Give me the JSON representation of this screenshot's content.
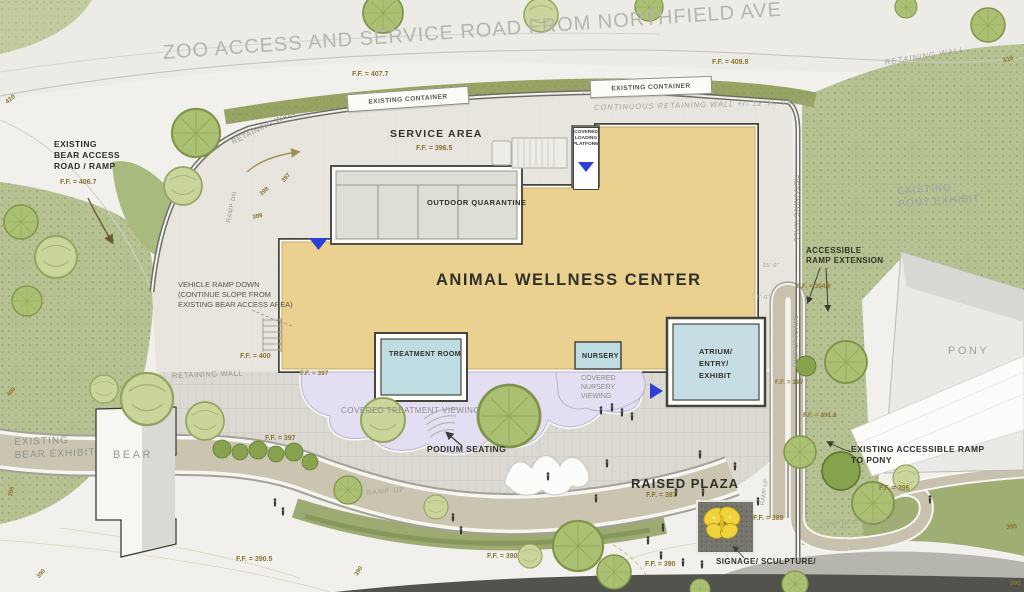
{
  "colors": {
    "building_fill": "#ebd190",
    "room_fill": "#bedce2",
    "viewing_canopy_fill": "#e4def2",
    "entry_arrow_blue": "#2d3fd6",
    "elevation_text_gold": "#8a7331",
    "landscape_green": "#b7c292",
    "sculpture_yellow": "#f0d33c"
  },
  "header": {
    "road_title": "ZOO ACCESS AND SERVICE ROAD FROM NORTHFIELD AVE",
    "ff_left": "F.F. = 407.7",
    "ff_right": "F.F. = 409.8",
    "container": "EXISTING CONTAINER",
    "retaining_wall": "RETAINING WALL",
    "continuous_wall": "CONTINUOUS RETAINING WALL +/- 12' H. VARIES",
    "dim_7_6": "7'-6\""
  },
  "service_area": {
    "title": "SERVICE AREA",
    "ff": "F.F. = 396.5",
    "quarantine": "OUTDOOR QUARANTINE",
    "loading_platform": "COVERED\nLOADING\nPLATFORM",
    "ramp_dn": "RAMP DN"
  },
  "west": {
    "bear_access": "EXISTING\nBEAR ACCESS\nROAD / RAMP",
    "bear_access_ff": "F.F. = 406.7",
    "vehicle_ramp": "VEHICLE RAMP DOWN\n(CONTINUE SLOPE FROM\nEXISTING BEAR ACCESS AREA)",
    "ff_400": "F.F. = 400",
    "bear_exhibit": "EXISTING\nBEAR EXHIBIT",
    "bear": "BEAR",
    "ff_390_5": "F.F. = 390.5"
  },
  "building": {
    "name": "ANIMAL WELLNESS CENTER",
    "treatment": "TREATMENT ROOM",
    "nursery": "NURSERY",
    "atrium": "ATRIUM/\nENTRY/\nEXHIBIT",
    "ff_397": "F.F. = 397"
  },
  "plaza": {
    "covered_treatment": "COVERED TREATMENT VIEWING",
    "covered_nursery": "COVERED\nNURSERY\nVIEWING",
    "podium": "PODIUM SEATING",
    "raised_plaza": "RAISED PLAZA",
    "ramp_up": "RAMP UP",
    "signage": "SIGNAGE/ SCULPTURE/",
    "ff_389": "F.F. = 389",
    "ff_390": "F.F. = 390"
  },
  "east": {
    "pony_exhibit": "EXISTING\nPONY EXHIBIT",
    "pony": "PONY",
    "accessible_ext": "ACCESSIBLE\nRAMP EXTENSION",
    "ff_394_6": "F.F. = 394.6",
    "ramp_up_awc": "RAMP UP TO AWC",
    "existing_ramp": "EXISTING ACCESSIBLE RAMP\nTO PONY",
    "ff_391_6": "F.F. = 391.6",
    "ff_396": "F.F. = 396",
    "ramp_up_pony": "RAMP UP TO PONY EXHIBIT",
    "dim_15": "15'-0\"",
    "dim_8": "8'-0\""
  },
  "contours": {
    "c390": "390",
    "c395": "395",
    "c397": "397",
    "c398": "398",
    "c399": "399",
    "c400": "400",
    "c410": "410"
  }
}
